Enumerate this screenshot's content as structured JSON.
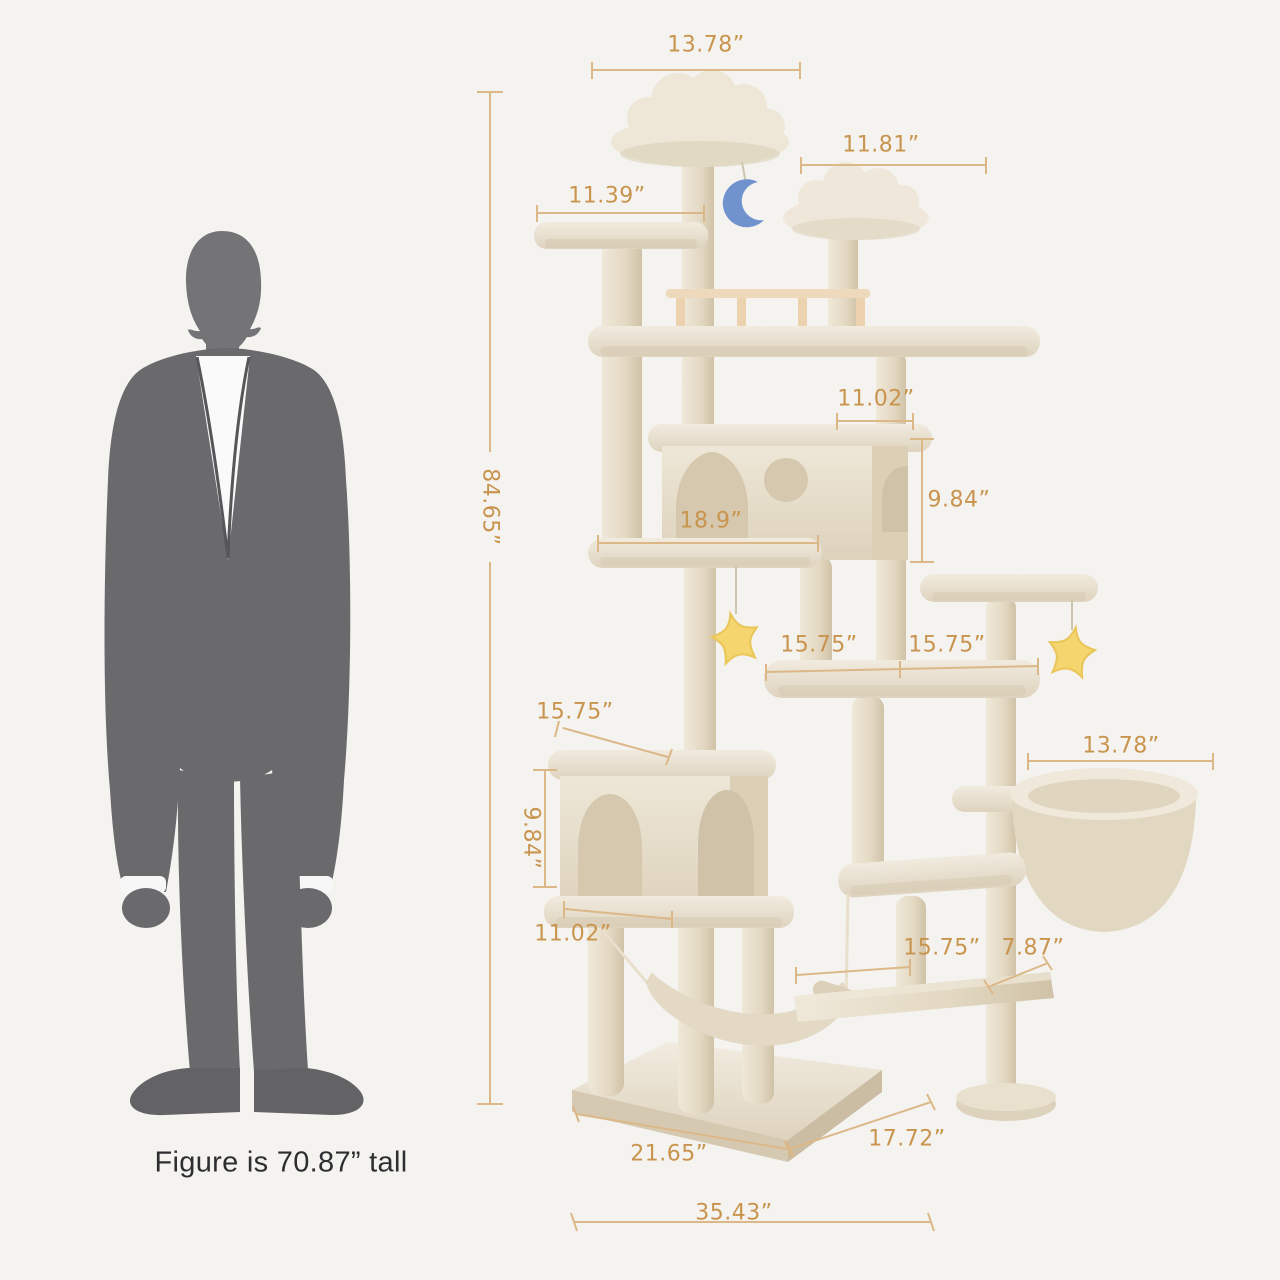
{
  "page": {
    "background_color": "#f4f3f0"
  },
  "human_figure": {
    "caption": "Figure is 70.87”  tall",
    "height": "70.87”",
    "silhouette_color": "#6a6a6d"
  },
  "dimension_style": {
    "text_color": "#c9944e",
    "line_color": "#dcb888"
  },
  "cat_tree": {
    "plush_color": "#ece4d3",
    "shadow_color": "#d7cab2",
    "toys": [
      {
        "name": "moon-plush-toy",
        "color": "#7193cd"
      },
      {
        "name": "star-plush-toy-left",
        "color": "#f4d56e"
      },
      {
        "name": "star-plush-toy-right",
        "color": "#f4d56e"
      }
    ]
  },
  "dimensions": {
    "top_perch_width": "13.78”",
    "right_perch_width": "11.81”",
    "upper_left_platform_width": "11.39”",
    "overall_height": "84.65”",
    "upper_condo_depth": "11.02”",
    "upper_condo_height": "9.84”",
    "upper_condo_platform_width": "18.9”",
    "middle_platform_left_width": "15.75”",
    "middle_platform_right_width": "15.75”",
    "lower_condo_top_width": "15.75”",
    "lower_condo_height": "9.84”",
    "hanging_basket_width": "13.78”",
    "lower_condo_bottom_width": "11.02”",
    "bottom_platform_length": "15.75”",
    "bottom_platform_depth": "7.87”",
    "base_width": "21.65”",
    "base_depth": "17.72”",
    "overall_width": "35.43”"
  }
}
